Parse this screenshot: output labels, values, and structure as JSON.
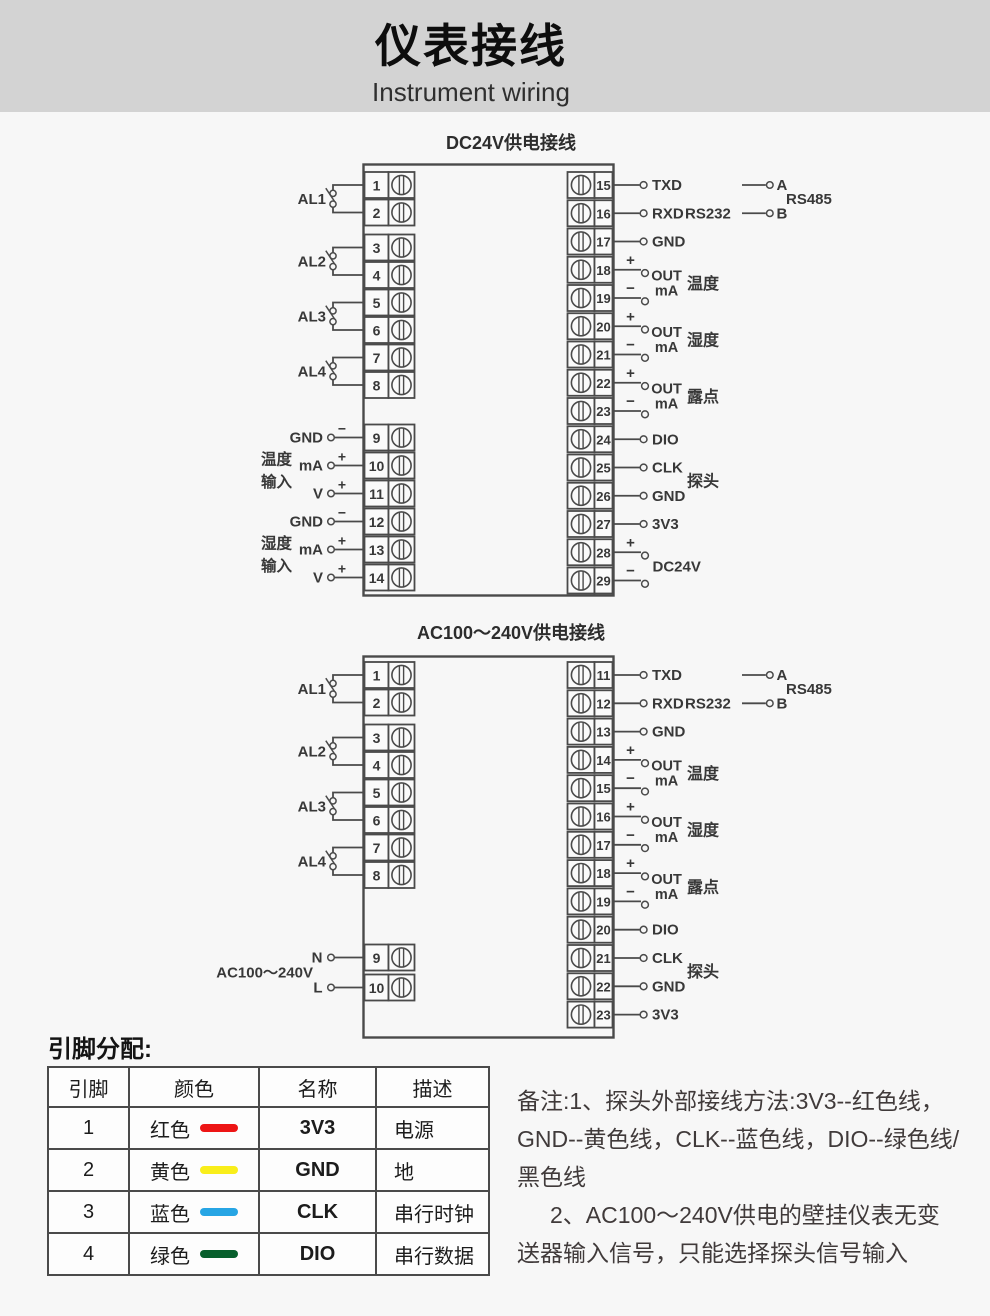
{
  "header": {
    "title": "仪表接线",
    "subtitle": "Instrument wiring",
    "background": "#d3d3d3"
  },
  "diagrams": [
    {
      "id": "dc",
      "title": "DC24V供电接线",
      "al_pairs": [
        {
          "label": "AL1",
          "pins": [
            "1",
            "2"
          ]
        },
        {
          "label": "AL2",
          "pins": [
            "3",
            "4"
          ]
        },
        {
          "label": "AL3",
          "pins": [
            "5",
            "6"
          ]
        },
        {
          "label": "AL4",
          "pins": [
            "7",
            "8"
          ]
        }
      ],
      "input_groups": [
        {
          "label_lines": [
            "温度",
            "输入"
          ],
          "rows": [
            {
              "label": "GND",
              "sign": "−",
              "pin": "9"
            },
            {
              "label": "mA",
              "sign": "+",
              "pin": "10"
            },
            {
              "label": "V",
              "sign": "+",
              "pin": "11"
            }
          ]
        },
        {
          "label_lines": [
            "湿度",
            "输入"
          ],
          "rows": [
            {
              "label": "GND",
              "sign": "−",
              "pin": "12"
            },
            {
              "label": "mA",
              "sign": "+",
              "pin": "13"
            },
            {
              "label": "V",
              "sign": "+",
              "pin": "14"
            }
          ]
        }
      ],
      "right_rows": [
        {
          "pin": "15",
          "kind": "plain",
          "label": "TXD"
        },
        {
          "pin": "16",
          "kind": "plain",
          "label": "RXD",
          "tag": "RS232"
        },
        {
          "pin": "17",
          "kind": "plain",
          "label": "GND"
        },
        {
          "pin": "18",
          "kind": "sign",
          "sign": "+"
        },
        {
          "pin": "19",
          "kind": "sign",
          "sign": "−"
        },
        {
          "pin": "20",
          "kind": "sign",
          "sign": "+"
        },
        {
          "pin": "21",
          "kind": "sign",
          "sign": "−"
        },
        {
          "pin": "22",
          "kind": "sign",
          "sign": "+"
        },
        {
          "pin": "23",
          "kind": "sign",
          "sign": "−"
        },
        {
          "pin": "24",
          "kind": "plain",
          "label": "DIO"
        },
        {
          "pin": "25",
          "kind": "plain",
          "label": "CLK"
        },
        {
          "pin": "26",
          "kind": "plain",
          "label": "GND"
        },
        {
          "pin": "27",
          "kind": "plain",
          "label": "3V3"
        },
        {
          "pin": "28",
          "kind": "sign",
          "sign": "+"
        },
        {
          "pin": "29",
          "kind": "sign",
          "sign": "−"
        }
      ],
      "out_groups": [
        {
          "pins": [
            "18",
            "19"
          ],
          "line1": "OUT",
          "line2": "mA",
          "label": "温度"
        },
        {
          "pins": [
            "20",
            "21"
          ],
          "line1": "OUT",
          "line2": "mA",
          "label": "湿度"
        },
        {
          "pins": [
            "22",
            "23"
          ],
          "line1": "OUT",
          "line2": "mA",
          "label": "露点"
        }
      ],
      "power_group": {
        "pins": [
          "28",
          "29"
        ],
        "label": "DC24V"
      },
      "probe": {
        "pins": [
          "25",
          "26"
        ],
        "label": "探头"
      },
      "rs485": {
        "pins": [
          "15",
          "16"
        ],
        "labels": [
          "A",
          "B"
        ],
        "name": "RS485"
      }
    },
    {
      "id": "ac",
      "title": "AC100～240V供电接线",
      "al_pairs": [
        {
          "label": "AL1",
          "pins": [
            "1",
            "2"
          ]
        },
        {
          "label": "AL2",
          "pins": [
            "3",
            "4"
          ]
        },
        {
          "label": "AL3",
          "pins": [
            "5",
            "6"
          ]
        },
        {
          "label": "AL4",
          "pins": [
            "7",
            "8"
          ]
        }
      ],
      "power_input": {
        "label": "AC100～240V",
        "rows": [
          {
            "label": "N",
            "pin": "9"
          },
          {
            "label": "L",
            "pin": "10"
          }
        ]
      },
      "right_rows": [
        {
          "pin": "11",
          "kind": "plain",
          "label": "TXD"
        },
        {
          "pin": "12",
          "kind": "plain",
          "label": "RXD",
          "tag": "RS232"
        },
        {
          "pin": "13",
          "kind": "plain",
          "label": "GND"
        },
        {
          "pin": "14",
          "kind": "sign",
          "sign": "+"
        },
        {
          "pin": "15",
          "kind": "sign",
          "sign": "−"
        },
        {
          "pin": "16",
          "kind": "sign",
          "sign": "+"
        },
        {
          "pin": "17",
          "kind": "sign",
          "sign": "−"
        },
        {
          "pin": "18",
          "kind": "sign",
          "sign": "+"
        },
        {
          "pin": "19",
          "kind": "sign",
          "sign": "−"
        },
        {
          "pin": "20",
          "kind": "plain",
          "label": "DIO"
        },
        {
          "pin": "21",
          "kind": "plain",
          "label": "CLK"
        },
        {
          "pin": "22",
          "kind": "plain",
          "label": "GND"
        },
        {
          "pin": "23",
          "kind": "plain",
          "label": "3V3"
        }
      ],
      "out_groups": [
        {
          "pins": [
            "14",
            "15"
          ],
          "line1": "OUT",
          "line2": "mA",
          "label": "温度"
        },
        {
          "pins": [
            "16",
            "17"
          ],
          "line1": "OUT",
          "line2": "mA",
          "label": "湿度"
        },
        {
          "pins": [
            "18",
            "19"
          ],
          "line1": "OUT",
          "line2": "mA",
          "label": "露点"
        }
      ],
      "probe": {
        "pins": [
          "21",
          "22"
        ],
        "label": "探头"
      },
      "rs485": {
        "pins": [
          "11",
          "12"
        ],
        "labels": [
          "A",
          "B"
        ],
        "name": "RS485"
      }
    }
  ],
  "pin_table": {
    "caption": "引脚分配:",
    "headers": [
      "引脚",
      "颜色",
      "名称",
      "描述"
    ],
    "rows": [
      {
        "pin": "1",
        "color": "红色",
        "hex": "#ed1515",
        "name": "3V3",
        "desc": "电源"
      },
      {
        "pin": "2",
        "color": "黄色",
        "hex": "#f9ee1b",
        "name": "GND",
        "desc": "地"
      },
      {
        "pin": "3",
        "color": "蓝色",
        "hex": "#27a5e4",
        "name": "CLK",
        "desc": "串行时钟"
      },
      {
        "pin": "4",
        "color": "绿色",
        "hex": "#075f2c",
        "name": "DIO",
        "desc": "串行数据"
      }
    ]
  },
  "notes": {
    "lines": [
      "备注:1、探头外部接线方法:3V3--红色线，",
      "GND--黄色线，CLK--蓝色线，DIO--绿色线/",
      "黑色线",
      "2、AC100～240V供电的壁挂仪表无变",
      "送器输入信号，只能选择探头信号输入"
    ]
  }
}
